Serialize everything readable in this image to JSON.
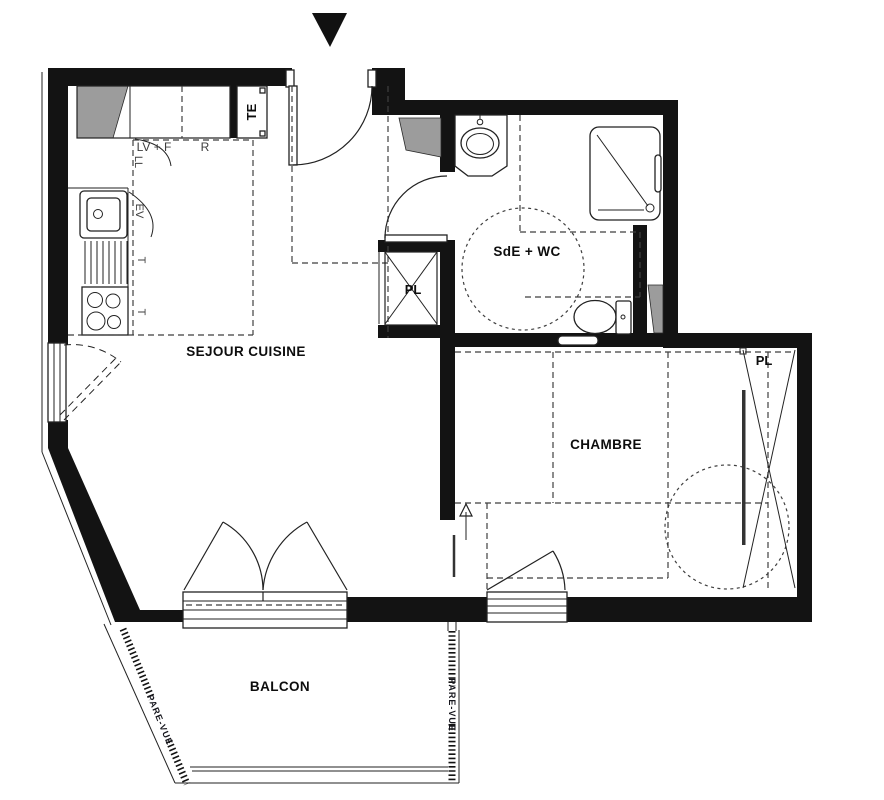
{
  "plan": {
    "rooms": {
      "sejour": "SEJOUR CUISINE",
      "chambre": "CHAMBRE",
      "sde_wc": "SdE + WC",
      "balcon": "BALCON"
    },
    "closets": {
      "hall_pl": "PL",
      "chambre_pl": "PL"
    },
    "kitchen": {
      "te": "TE",
      "lv_f": "LV + F",
      "fridge": "R",
      "ll": "LL",
      "ev": "EV",
      "t_upper": "T",
      "t_lower": "T"
    },
    "balcony": {
      "pare_vue_left": "PARE-VUE",
      "pare_vue_right": "PARE-VUE"
    },
    "colors": {
      "ink": "#131313",
      "wall_shading": "#9c9c9c",
      "dashed_lines": "#3f3f3f",
      "background": "#ffffff"
    }
  }
}
